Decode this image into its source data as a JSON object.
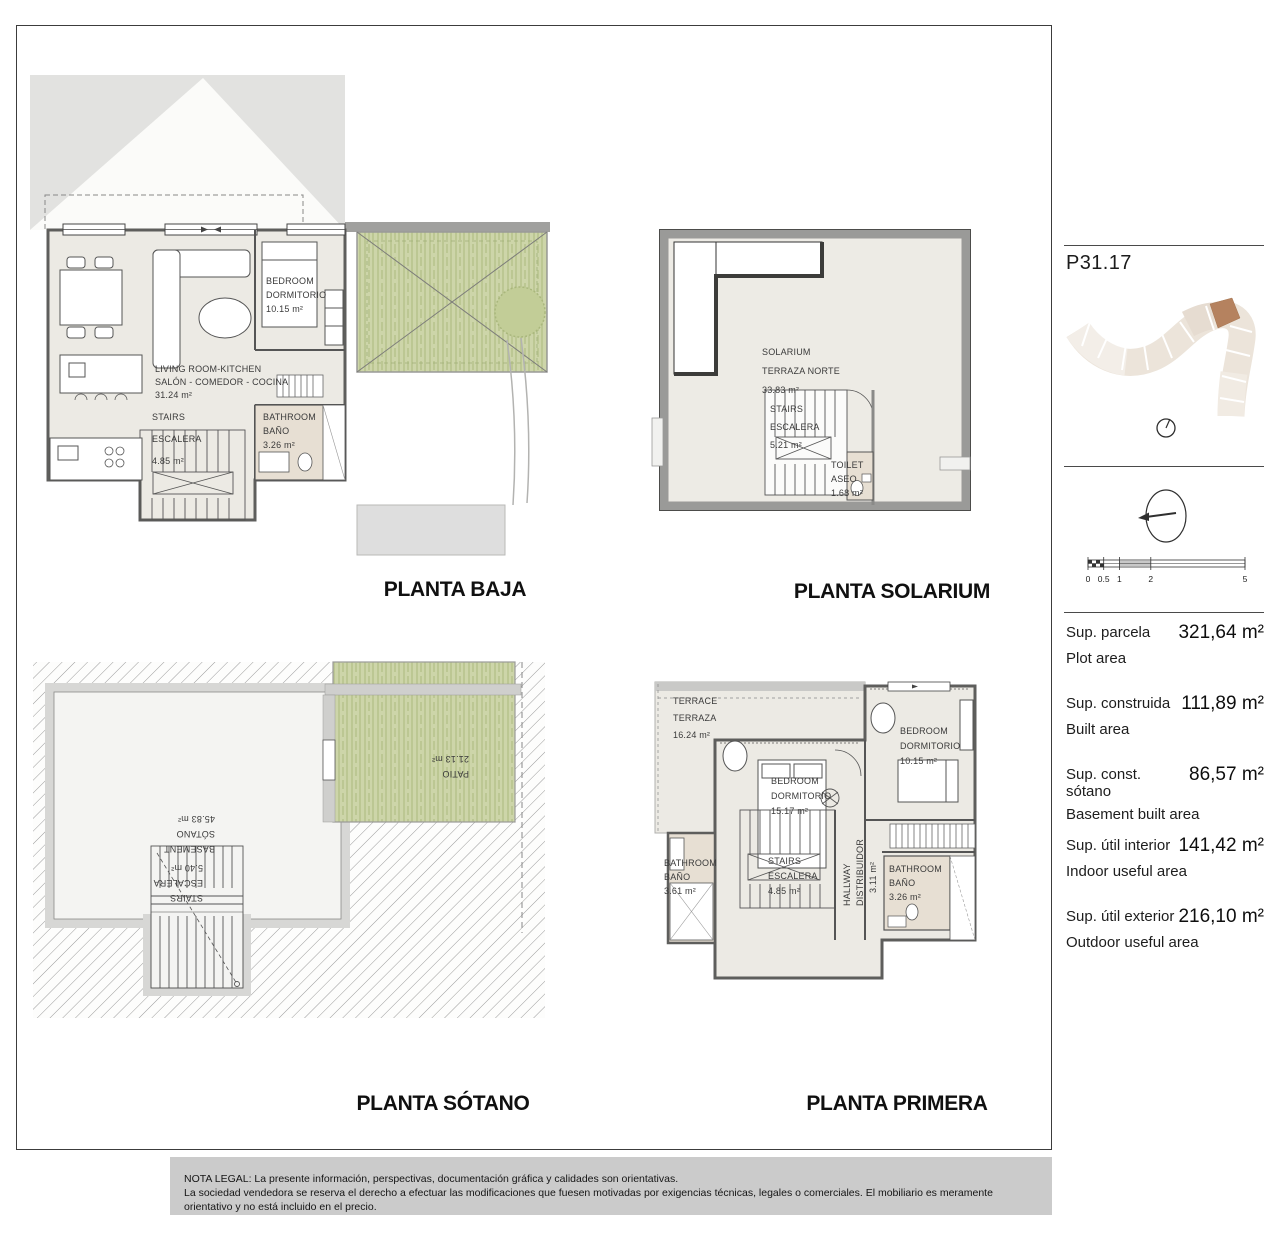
{
  "plans": {
    "baja": {
      "title": "PLANTA BAJA",
      "rooms": {
        "living": {
          "en": "LIVING ROOM-KITCHEN",
          "es": "SALÓN - COMEDOR - COCINA",
          "area": "31.24 m²"
        },
        "stairs": {
          "en": "STAIRS",
          "es": "ESCALERA",
          "area": "4.85 m²"
        },
        "bath": {
          "en": "BATHROOM",
          "es": "BAÑO",
          "area": "3.26 m²"
        },
        "bedroom": {
          "en": "BEDROOM",
          "es": "DORMITORIO",
          "area": "10.15 m²"
        }
      }
    },
    "solarium": {
      "title": "PLANTA SOLARIUM",
      "rooms": {
        "solarium": {
          "en": "SOLARIUM",
          "es": "TERRAZA NORTE",
          "area": "33.83 m²"
        },
        "stairs": {
          "en": "STAIRS",
          "es": "ESCALERA",
          "area": "5.21 m²"
        },
        "toilet": {
          "en": "TOILET",
          "es": "ASEO",
          "area": "1.68 m²"
        }
      }
    },
    "sotano": {
      "title": "PLANTA SÓTANO",
      "rooms": {
        "basement": {
          "en": "BASEMENT",
          "es": "SÓTANO",
          "area": "45.83 m²"
        },
        "stairs": {
          "en": "STAIRS",
          "es": "ESCALERA",
          "area": "5.40 m²"
        },
        "patio": {
          "en": "PATIO",
          "area": "21.13 m²"
        }
      }
    },
    "primera": {
      "title": "PLANTA PRIMERA",
      "rooms": {
        "terrace": {
          "en": "TERRACE",
          "es": "TERRAZA",
          "area": "16.24 m²"
        },
        "bedroom_main": {
          "en": "BEDROOM",
          "es": "DORMITORIO",
          "area": "15.17 m²"
        },
        "bedroom_2": {
          "en": "BEDROOM",
          "es": "DORMITORIO",
          "area": "10.15 m²"
        },
        "bath_left": {
          "en": "BATHROOM",
          "es": "BAÑO",
          "area": "3.61 m²"
        },
        "bath_right": {
          "en": "BATHROOM",
          "es": "BAÑO",
          "area": "3.26 m²"
        },
        "stairs": {
          "en": "STAIRS",
          "es": "ESCALERA",
          "area": "4.85 m²"
        },
        "hallway": {
          "en": "HALLWAY",
          "es": "DISTRIBUIDOR",
          "area": "3.11 m²"
        }
      }
    }
  },
  "sidebar": {
    "unit_code": "P31.17",
    "scale_ticks": [
      "0",
      "0.5",
      "1",
      "2",
      "5"
    ],
    "areas": [
      {
        "label_es": "Sup. parcela",
        "label_en": "Plot area",
        "value": "321,64 m²"
      },
      {
        "label_es": "Sup. construida",
        "label_en": "Built area",
        "value": "111,89 m²"
      },
      {
        "label_es": "Sup. const. sótano",
        "label_en": "Basement built area",
        "value": "86,57 m²"
      },
      {
        "label_es": "Sup. útil interior",
        "label_en": "Indoor useful area",
        "value": "141,42 m²"
      },
      {
        "label_es": "Sup. útil exterior",
        "label_en": "Outdoor useful area",
        "value": "216,10 m²"
      }
    ]
  },
  "legal": {
    "line1": "NOTA LEGAL: La presente información, perspectivas, documentación gráfica y calidades son orientativas.",
    "line2": "La sociedad vendedora se reserva el derecho a efectuar las modificaciones que fuesen motivadas por exigencias técnicas, legales o comerciales. El mobiliario es meramente orientativo y no está incluido en el precio."
  },
  "colors": {
    "garden_green": "#cdd5a9",
    "wall_gray": "#9c9c9a",
    "bath_beige": "#e7dfd3",
    "highlight_plot_brown": "#b5825f",
    "legal_bar_gray": "#cbcbcb"
  }
}
